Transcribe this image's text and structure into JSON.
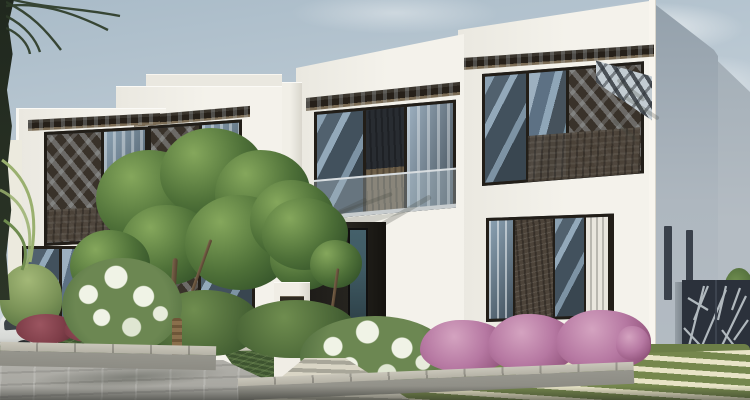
{
  "scene": {
    "type": "exterior-architectural-render",
    "subject": "row-of-modern-white-townhouse-villas-with-landscaped-garden",
    "elements": [
      "sky",
      "clouds",
      "palm-fronds",
      "white-villas",
      "perforated-window-screens",
      "window-canopies",
      "glass-balcony",
      "entrance-door",
      "mailbox-pillar",
      "white-car",
      "green-trees",
      "white-flowering-bushes",
      "pink-bougainvillea",
      "maroon-shrubs",
      "stone-planters",
      "paved-walkway",
      "striped-grass-paver-lawn",
      "laser-cut-screen-fence",
      "distant-gray-building"
    ]
  },
  "colors": {
    "sky_top": "#a9bbc8",
    "sky_mid": "#c3cfd8",
    "sky_low": "#dae0e3",
    "cloud": "#e6ebee",
    "wall_white": "#f4f2eb",
    "wall_white_dim": "#eae8e0",
    "wall_shadow": "#d9d6cd",
    "distant_wall": "#9aa6b0",
    "distant_wall_light": "#b4bcc3",
    "frame_dark": "#221e18",
    "glass_dark": "#39444f",
    "glass_light": "#8ba1b2",
    "panel_bronze": "#39322a",
    "panel_stone": "#4d443a",
    "awning_dark": "#262019",
    "awning_under": "#7b6c55",
    "door_glass": "#3f5a63",
    "fence_dark": "#2b313b",
    "fence_light": "#c9d1d6",
    "tree_light": "#85a75c",
    "tree_mid": "#4e7038",
    "tree_dark": "#2c4a25",
    "bush_green": "#4c6838",
    "flower_white": "#f0f3e6",
    "boug": "#b678a2",
    "boug_dark": "#8e5078",
    "maroon": "#7f3e49",
    "grass": "#75874d",
    "paver_light": "#e8e4c6",
    "pavement": "#a5a49e",
    "curb_top": "#c9c6ba",
    "curb_face": "#8d8c84",
    "trunk": "#6b5640",
    "palm_dark": "#2d3b28",
    "palm_light": "#9ab06f",
    "car_body": "#e9ebe8",
    "car_glass": "#3c4347",
    "pillar": "#f0ede5",
    "plaque": "#2e2921"
  }
}
